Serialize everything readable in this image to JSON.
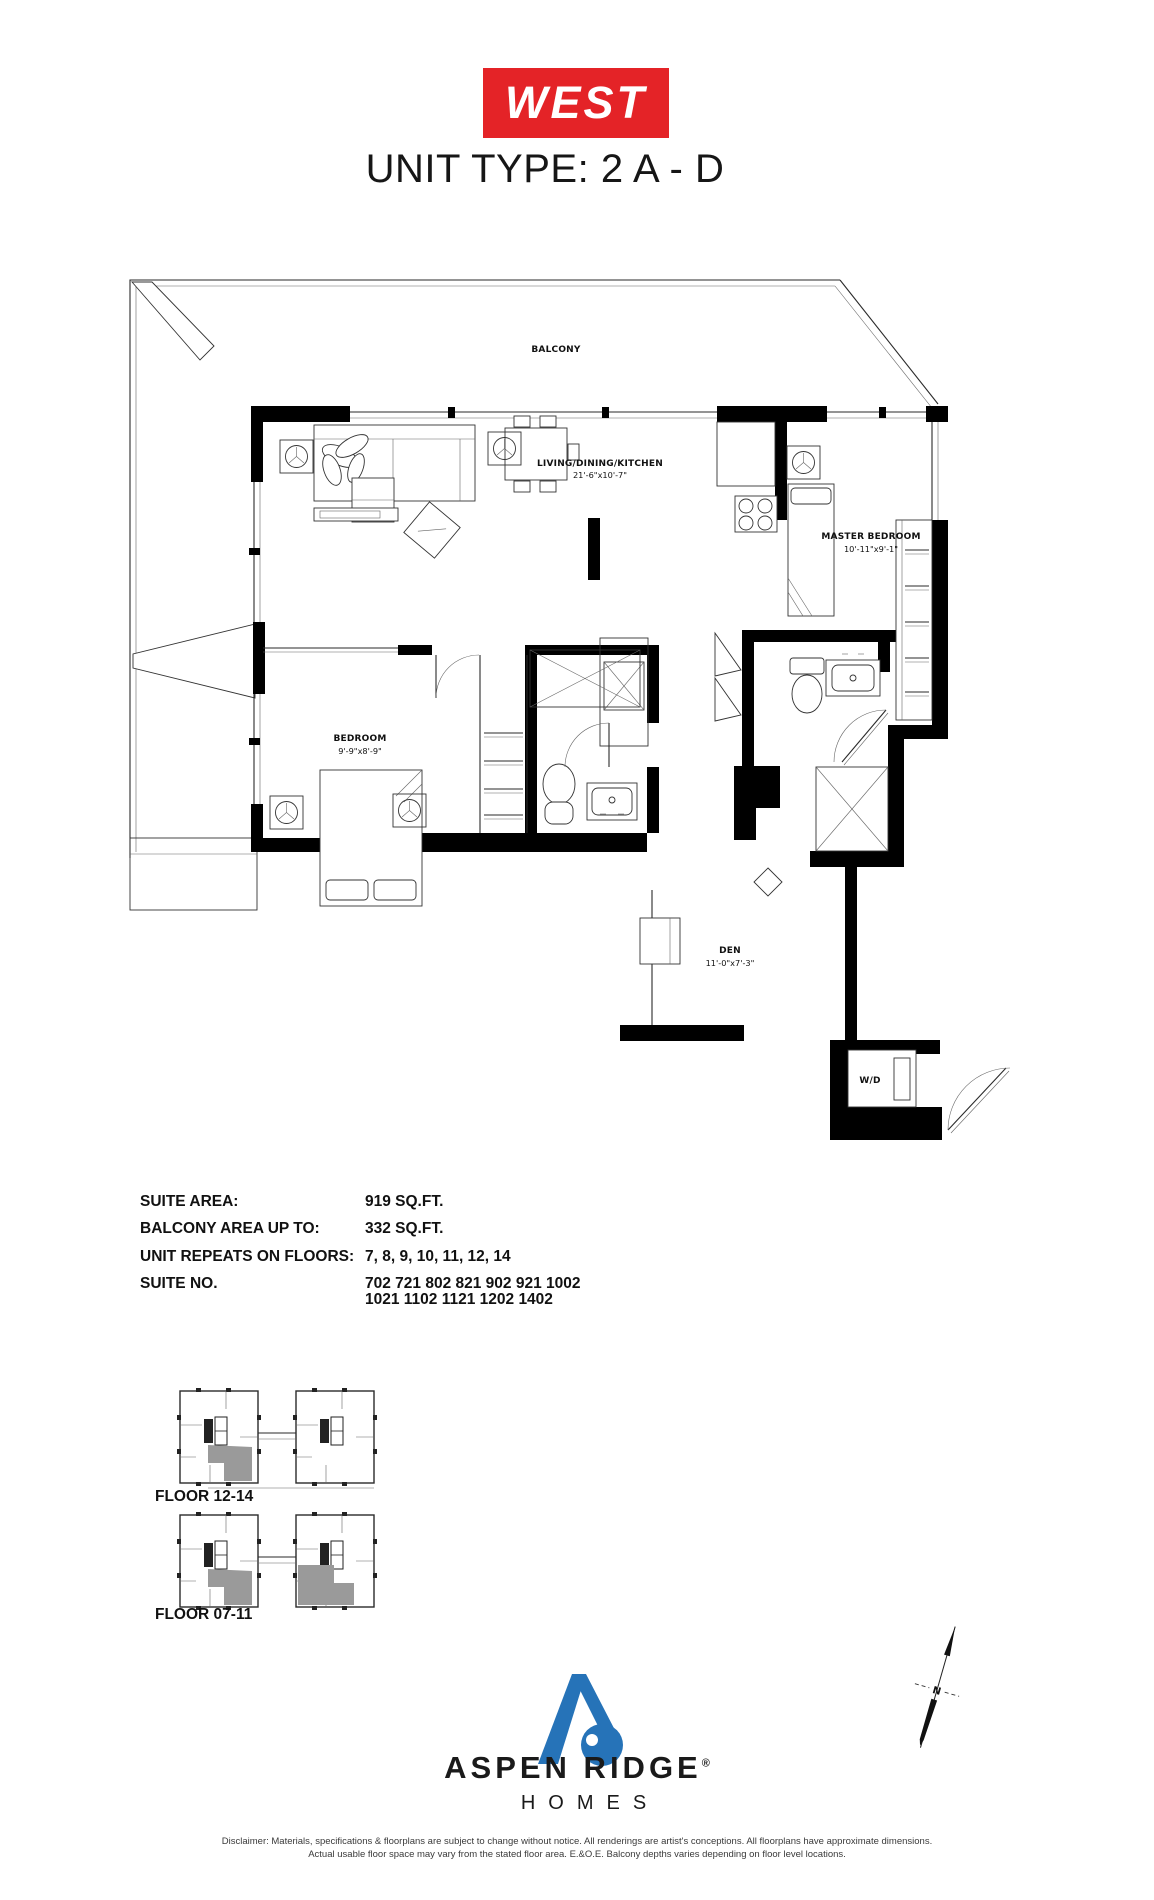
{
  "header": {
    "brand": "WEST",
    "title": "UNIT TYPE: 2 A - D"
  },
  "plan": {
    "balcony": "BALCONY",
    "living_name": "LIVING/DINING/KITCHEN",
    "living_dims": "21'-6\"x10'-7\"",
    "master_name": "MASTER BEDROOM",
    "master_dims": "10'-11\"x9'-1\"",
    "bedroom_name": "BEDROOM",
    "bedroom_dims": "9'-9\"x8'-9\"",
    "den_name": "DEN",
    "den_dims": "11'-0\"x7'-3\"",
    "wd": "W/D"
  },
  "specs": {
    "suite_area_label": "SUITE AREA:",
    "suite_area_value": "919 SQ.FT.",
    "balcony_area_label": "BALCONY AREA UP TO:",
    "balcony_area_value": "332 SQ.FT.",
    "floors_label": "UNIT REPEATS ON FLOORS:",
    "floors_value": "7, 8, 9, 10, 11, 12, 14",
    "suite_no_label": "SUITE NO.",
    "suite_no_line1": "702 721 802 821 902 921 1002",
    "suite_no_line2": "1021 1102 1121 1202 1402"
  },
  "key_plans": {
    "floor_12_14": "FLOOR 12-14",
    "floor_07_11": "FLOOR 07-11"
  },
  "compass": {
    "north": "N"
  },
  "footer": {
    "brand_name": "ASPEN RIDGE",
    "registered": "®",
    "brand_sub": "HOMES",
    "disclaimer_line1": "Disclaimer: Materials, specifications & floorplans are subject to change without notice. All renderings are artist's conceptions. All floorplans have approximate dimensions.",
    "disclaimer_line2": "Actual usable floor space may vary from the stated floor area. E.&O.E. Balcony depths varies depending on floor level locations."
  },
  "colors": {
    "brand_red": "#e42327",
    "logo_blue": "#2673b8",
    "keyplan_gray": "#9a9a9a"
  }
}
